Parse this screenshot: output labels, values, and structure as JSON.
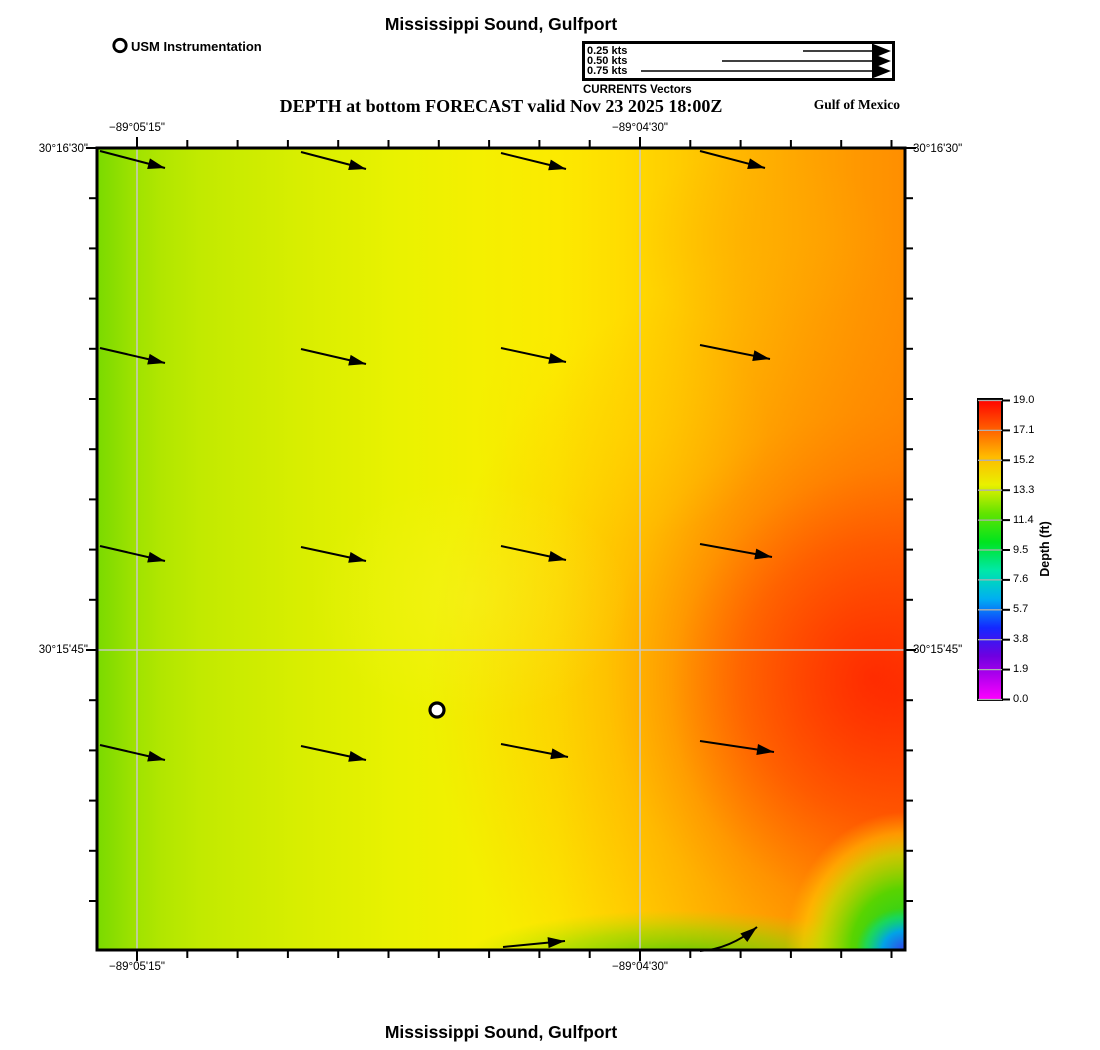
{
  "header": {
    "title": "Mississippi Sound, Gulfport",
    "instrument_legend": "USM Instrumentation",
    "vector_legend": {
      "caption": "CURRENTS Vectors",
      "tip_x": 891,
      "entries": [
        {
          "label": "0.25 kts",
          "tail_x": 803,
          "y": 51
        },
        {
          "label": "0.50 kts",
          "tail_x": 722,
          "y": 61
        },
        {
          "label": "0.75 kts",
          "tail_x": 641,
          "y": 71
        }
      ]
    },
    "subtitle": "DEPTH at bottom FORECAST valid Nov 23 2025 18:00Z",
    "region_label": "Gulf of Mexico"
  },
  "footer": {
    "title": "Mississippi Sound, Gulfport"
  },
  "map": {
    "frame": {
      "left": 97,
      "top": 148,
      "right": 905,
      "bottom": 950
    },
    "x_axis_labels": [
      {
        "text": "−89°05'15\"",
        "x": 137
      },
      {
        "text": "−89°04'30\"",
        "x": 640
      }
    ],
    "y_axis_labels": [
      {
        "text": "30°16'30\"",
        "y": 149
      },
      {
        "text": "30°15'45\"",
        "y": 650
      }
    ],
    "ticks": {
      "x_anchor": 137,
      "x_step": 50.3,
      "y_anchor": 148,
      "y_step": 50.2
    },
    "gridlines": {
      "x": [
        137,
        640
      ],
      "y": [
        650
      ]
    },
    "gridline_color": "#c8c8c8",
    "station_marker": {
      "name": "USM Instrumentation",
      "x": 437,
      "y": 710
    },
    "vectors": [
      [
        100,
        151,
        165,
        168
      ],
      [
        301,
        152,
        366,
        169
      ],
      [
        501,
        153,
        566,
        169
      ],
      [
        700,
        151,
        765,
        168
      ],
      [
        100,
        348,
        165,
        363
      ],
      [
        301,
        349,
        366,
        364
      ],
      [
        501,
        348,
        566,
        362
      ],
      [
        700,
        345,
        770,
        359
      ],
      [
        100,
        546,
        165,
        561
      ],
      [
        301,
        547,
        366,
        561
      ],
      [
        501,
        546,
        566,
        560
      ],
      [
        700,
        544,
        772,
        557
      ],
      [
        100,
        745,
        165,
        760
      ],
      [
        301,
        746,
        366,
        760
      ],
      [
        501,
        744,
        568,
        757
      ],
      [
        700,
        741,
        774,
        752
      ],
      [
        503,
        947,
        565,
        941
      ],
      [
        700,
        951,
        730,
        949,
        757,
        927
      ]
    ]
  },
  "colorbar": {
    "label": "Depth (ft)",
    "ticks": [
      "19.0",
      "17.1",
      "15.2",
      "13.3",
      "11.4",
      "9.5",
      "7.6",
      "5.7",
      "3.8",
      "1.9",
      "0.0"
    ]
  },
  "chart_data": {
    "type": "heatmap",
    "title": "Mississippi Sound, Gulfport",
    "subtitle": "DEPTH at bottom FORECAST valid Nov 23 2025 18:00Z",
    "region": "Gulf of Mexico",
    "colorbar": {
      "label": "Depth (ft)",
      "ticks": [
        19.0,
        17.1,
        15.2,
        13.3,
        11.4,
        9.5,
        7.6,
        5.7,
        3.8,
        1.9,
        0.0
      ],
      "range": [
        0.0,
        19.0
      ],
      "colors_top_to_bottom": [
        "#ff0000",
        "#ff5a00",
        "#ffb900",
        "#e9f000",
        "#62e400",
        "#00e41e",
        "#00e8a8",
        "#00aef2",
        "#1428ff",
        "#7000e0",
        "#ff00ff"
      ]
    },
    "x_tick_labels": [
      "−89°05'15\"",
      "−89°04'30\""
    ],
    "y_tick_labels": [
      "30°16'30\"",
      "30°15'45\""
    ],
    "depth_field_ft_5x5_west_to_east_north_to_south": [
      [
        13.8,
        14.8,
        15.6,
        16.4,
        16.9
      ],
      [
        14.0,
        15.0,
        15.9,
        16.9,
        17.6
      ],
      [
        14.0,
        15.2,
        16.1,
        17.3,
        18.4
      ],
      [
        13.8,
        15.0,
        16.1,
        17.6,
        18.8
      ],
      [
        13.2,
        14.6,
        15.2,
        13.6,
        4.5
      ]
    ],
    "current_vectors": {
      "legend_speeds_kts": [
        0.25,
        0.5,
        0.75
      ],
      "field_description": "4×4 grid of eastward arrows (~0.2 kts, slight southward tilt) plus two arrows along the south boundary",
      "direction": "eastward"
    },
    "station": {
      "name": "USM Instrumentation",
      "symbol": "white circle, black outline"
    }
  }
}
